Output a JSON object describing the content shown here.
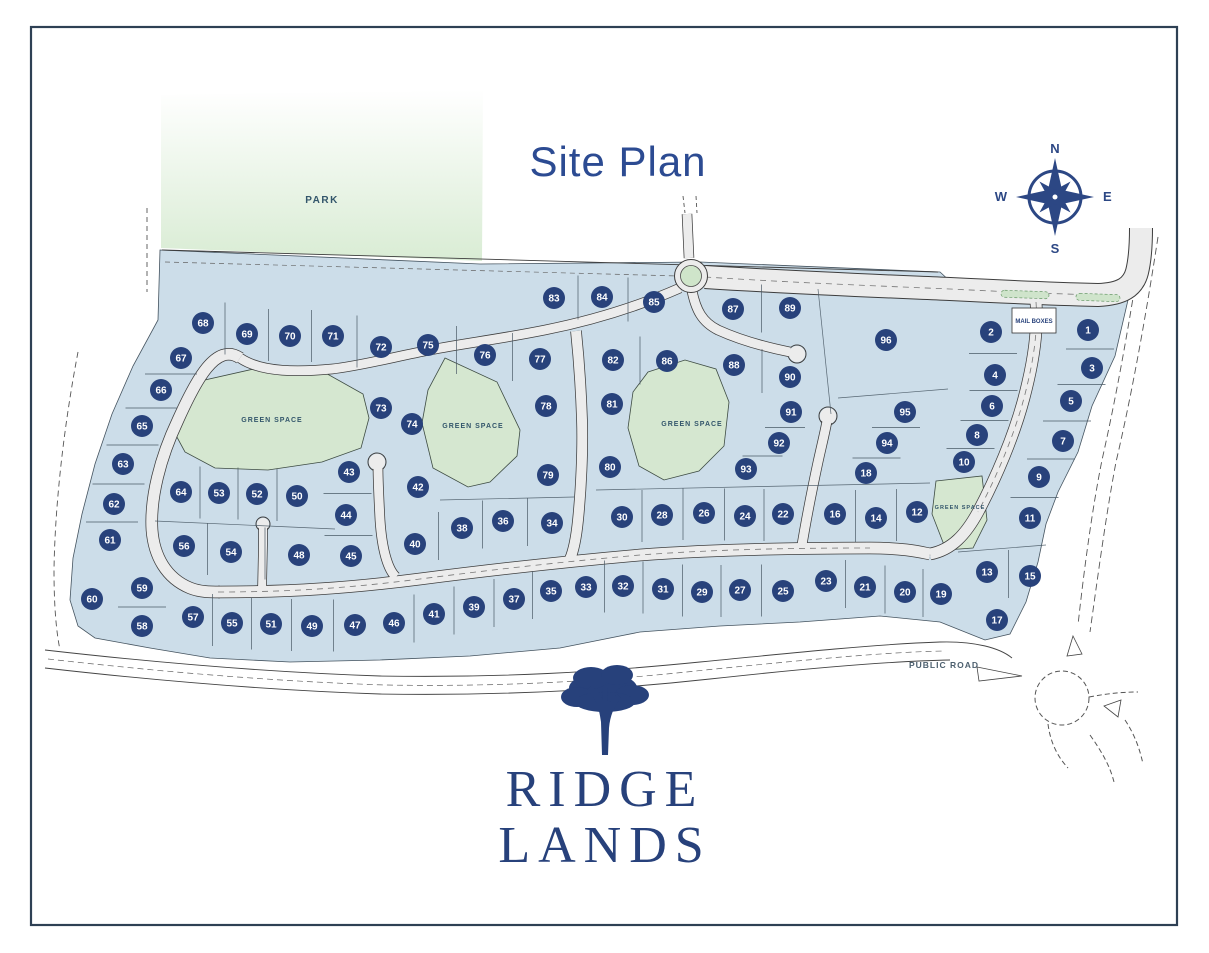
{
  "title": "Site Plan",
  "park_label": "PARK",
  "mail_boxes_label": "MAIL BOXES",
  "public_road_label": "PUBLIC ROAD",
  "compass": {
    "n": "N",
    "e": "E",
    "s": "S",
    "w": "W"
  },
  "logo": {
    "line1": "RIDGE",
    "line2": "LANDS"
  },
  "colors": {
    "navy": "#28427b",
    "title_blue": "#2c4b92",
    "lot_blue": "#ccdde9",
    "green": "#d5e7d0",
    "park_green": "#d9ecd4",
    "road_fill": "#ececec",
    "road_edge": "#3d3d3d",
    "line": "#4a5a66",
    "frame": "#2e4054",
    "green_label": "#33566b",
    "public_road_text": "#4c5f6e"
  },
  "green_space_labels": [
    {
      "label": "GREEN SPACE",
      "x": 272,
      "y": 422,
      "size": 7
    },
    {
      "label": "GREEN SPACE",
      "x": 473,
      "y": 428,
      "size": 7
    },
    {
      "label": "GREEN SPACE",
      "x": 692,
      "y": 426,
      "size": 7
    },
    {
      "label": "GREEN SPACE",
      "x": 960,
      "y": 509,
      "size": 5.5
    }
  ],
  "lots": [
    {
      "n": 1,
      "x": 1088,
      "y": 330
    },
    {
      "n": 2,
      "x": 991,
      "y": 332
    },
    {
      "n": 3,
      "x": 1092,
      "y": 368
    },
    {
      "n": 4,
      "x": 995,
      "y": 375
    },
    {
      "n": 5,
      "x": 1071,
      "y": 401
    },
    {
      "n": 6,
      "x": 992,
      "y": 406
    },
    {
      "n": 7,
      "x": 1063,
      "y": 441
    },
    {
      "n": 8,
      "x": 977,
      "y": 435
    },
    {
      "n": 9,
      "x": 1039,
      "y": 477
    },
    {
      "n": 10,
      "x": 964,
      "y": 462
    },
    {
      "n": 11,
      "x": 1030,
      "y": 518
    },
    {
      "n": 12,
      "x": 917,
      "y": 512
    },
    {
      "n": 13,
      "x": 987,
      "y": 572
    },
    {
      "n": 14,
      "x": 876,
      "y": 518
    },
    {
      "n": 15,
      "x": 1030,
      "y": 576
    },
    {
      "n": 16,
      "x": 835,
      "y": 514
    },
    {
      "n": 17,
      "x": 997,
      "y": 620
    },
    {
      "n": 18,
      "x": 866,
      "y": 473
    },
    {
      "n": 19,
      "x": 941,
      "y": 594
    },
    {
      "n": 20,
      "x": 905,
      "y": 592
    },
    {
      "n": 21,
      "x": 865,
      "y": 587
    },
    {
      "n": 22,
      "x": 783,
      "y": 514
    },
    {
      "n": 23,
      "x": 826,
      "y": 581
    },
    {
      "n": 24,
      "x": 745,
      "y": 516
    },
    {
      "n": 25,
      "x": 783,
      "y": 591
    },
    {
      "n": 26,
      "x": 704,
      "y": 513
    },
    {
      "n": 27,
      "x": 740,
      "y": 590
    },
    {
      "n": 28,
      "x": 662,
      "y": 515
    },
    {
      "n": 29,
      "x": 702,
      "y": 592
    },
    {
      "n": 30,
      "x": 622,
      "y": 517
    },
    {
      "n": 31,
      "x": 663,
      "y": 589
    },
    {
      "n": 32,
      "x": 623,
      "y": 586
    },
    {
      "n": 33,
      "x": 586,
      "y": 587
    },
    {
      "n": 34,
      "x": 552,
      "y": 523
    },
    {
      "n": 35,
      "x": 551,
      "y": 591
    },
    {
      "n": 36,
      "x": 503,
      "y": 521
    },
    {
      "n": 37,
      "x": 514,
      "y": 599
    },
    {
      "n": 38,
      "x": 462,
      "y": 528
    },
    {
      "n": 39,
      "x": 474,
      "y": 607
    },
    {
      "n": 40,
      "x": 415,
      "y": 544
    },
    {
      "n": 41,
      "x": 434,
      "y": 614
    },
    {
      "n": 42,
      "x": 418,
      "y": 487
    },
    {
      "n": 43,
      "x": 349,
      "y": 472
    },
    {
      "n": 44,
      "x": 346,
      "y": 515
    },
    {
      "n": 45,
      "x": 351,
      "y": 556
    },
    {
      "n": 46,
      "x": 394,
      "y": 623
    },
    {
      "n": 47,
      "x": 355,
      "y": 625
    },
    {
      "n": 48,
      "x": 299,
      "y": 555
    },
    {
      "n": 49,
      "x": 312,
      "y": 626
    },
    {
      "n": 50,
      "x": 297,
      "y": 496
    },
    {
      "n": 51,
      "x": 271,
      "y": 624
    },
    {
      "n": 52,
      "x": 257,
      "y": 494
    },
    {
      "n": 53,
      "x": 219,
      "y": 493
    },
    {
      "n": 54,
      "x": 231,
      "y": 552
    },
    {
      "n": 55,
      "x": 232,
      "y": 623
    },
    {
      "n": 56,
      "x": 184,
      "y": 546
    },
    {
      "n": 57,
      "x": 193,
      "y": 617
    },
    {
      "n": 58,
      "x": 142,
      "y": 626
    },
    {
      "n": 59,
      "x": 142,
      "y": 588
    },
    {
      "n": 60,
      "x": 92,
      "y": 599
    },
    {
      "n": 61,
      "x": 110,
      "y": 540
    },
    {
      "n": 62,
      "x": 114,
      "y": 504
    },
    {
      "n": 63,
      "x": 123,
      "y": 464
    },
    {
      "n": 64,
      "x": 181,
      "y": 492
    },
    {
      "n": 65,
      "x": 142,
      "y": 426
    },
    {
      "n": 66,
      "x": 161,
      "y": 390
    },
    {
      "n": 67,
      "x": 181,
      "y": 358
    },
    {
      "n": 68,
      "x": 203,
      "y": 323
    },
    {
      "n": 69,
      "x": 247,
      "y": 334
    },
    {
      "n": 70,
      "x": 290,
      "y": 336
    },
    {
      "n": 71,
      "x": 333,
      "y": 336
    },
    {
      "n": 72,
      "x": 381,
      "y": 347
    },
    {
      "n": 73,
      "x": 381,
      "y": 408
    },
    {
      "n": 74,
      "x": 412,
      "y": 424
    },
    {
      "n": 75,
      "x": 428,
      "y": 345
    },
    {
      "n": 76,
      "x": 485,
      "y": 355
    },
    {
      "n": 77,
      "x": 540,
      "y": 359
    },
    {
      "n": 78,
      "x": 546,
      "y": 406
    },
    {
      "n": 79,
      "x": 548,
      "y": 475
    },
    {
      "n": 80,
      "x": 610,
      "y": 467
    },
    {
      "n": 81,
      "x": 612,
      "y": 404
    },
    {
      "n": 82,
      "x": 613,
      "y": 360
    },
    {
      "n": 83,
      "x": 554,
      "y": 298
    },
    {
      "n": 84,
      "x": 602,
      "y": 297
    },
    {
      "n": 85,
      "x": 654,
      "y": 302
    },
    {
      "n": 86,
      "x": 667,
      "y": 361
    },
    {
      "n": 87,
      "x": 733,
      "y": 309
    },
    {
      "n": 88,
      "x": 734,
      "y": 365
    },
    {
      "n": 89,
      "x": 790,
      "y": 308
    },
    {
      "n": 90,
      "x": 790,
      "y": 377
    },
    {
      "n": 91,
      "x": 791,
      "y": 412
    },
    {
      "n": 92,
      "x": 779,
      "y": 443
    },
    {
      "n": 93,
      "x": 746,
      "y": 469
    },
    {
      "n": 94,
      "x": 887,
      "y": 443
    },
    {
      "n": 95,
      "x": 905,
      "y": 412
    },
    {
      "n": 96,
      "x": 886,
      "y": 340
    }
  ],
  "lot_dividers": [
    {
      "dir": "v",
      "half": 26,
      "lots": [
        68,
        69,
        70,
        71,
        72
      ]
    },
    {
      "dir": "v",
      "half": 24,
      "lots": [
        75,
        76,
        77
      ]
    },
    {
      "dir": "v",
      "half": 22,
      "lots": [
        83,
        84,
        85
      ]
    },
    {
      "dir": "v",
      "half": 24,
      "lots": [
        87,
        89
      ]
    },
    {
      "dir": "v",
      "half": 24,
      "lots": [
        82,
        86
      ]
    },
    {
      "dir": "v",
      "half": 22,
      "lots": [
        88,
        90
      ]
    },
    {
      "dir": "v",
      "half": 26,
      "lots": [
        64,
        53,
        52,
        50
      ]
    },
    {
      "dir": "v",
      "half": 26,
      "lots": [
        56,
        54,
        48
      ]
    },
    {
      "dir": "v",
      "half": 26,
      "lots": [
        57,
        55,
        51,
        49,
        47
      ]
    },
    {
      "dir": "v",
      "half": 24,
      "lots": [
        46,
        41,
        39,
        37,
        35
      ]
    },
    {
      "dir": "v",
      "half": 26,
      "lots": [
        33,
        32,
        31,
        29,
        27,
        25
      ]
    },
    {
      "dir": "v",
      "half": 24,
      "lots": [
        23,
        21,
        20,
        19
      ]
    },
    {
      "dir": "v",
      "half": 24,
      "lots": [
        40,
        38,
        36,
        34
      ]
    },
    {
      "dir": "v",
      "half": 26,
      "lots": [
        30,
        28,
        26,
        24,
        22
      ]
    },
    {
      "dir": "v",
      "half": 26,
      "lots": [
        16,
        14,
        12
      ]
    },
    {
      "dir": "v",
      "half": 24,
      "lots": [
        13,
        15
      ]
    },
    {
      "dir": "h",
      "half": 26,
      "lots": [
        67,
        66,
        65,
        63,
        62,
        61
      ]
    },
    {
      "dir": "h",
      "half": 24,
      "lots": [
        2,
        4,
        6,
        8,
        10
      ]
    },
    {
      "dir": "h",
      "half": 24,
      "lots": [
        1,
        3,
        5,
        7,
        9,
        11
      ]
    },
    {
      "dir": "h",
      "half": 24,
      "lots": [
        95,
        94,
        18
      ]
    },
    {
      "dir": "h",
      "half": 24,
      "lots": [
        43,
        44,
        45
      ]
    },
    {
      "dir": "h",
      "half": 24,
      "lots": [
        59,
        58
      ]
    },
    {
      "dir": "h",
      "half": 20,
      "lots": [
        91,
        92,
        93
      ]
    }
  ]
}
